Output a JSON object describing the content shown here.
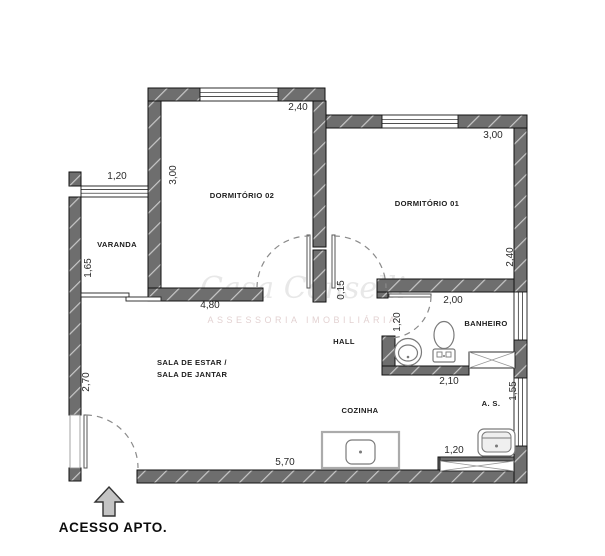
{
  "rooms": {
    "dorm02": "DORMITÓRIO 02",
    "dorm01": "DORMITÓRIO 01",
    "varanda": "VARANDA",
    "sala_line1": "SALA DE ESTAR /",
    "sala_line2": "SALA DE JANTAR",
    "hall": "HALL",
    "banheiro": "BANHEIRO",
    "cozinha": "COZINHA",
    "area_servico": "A. S."
  },
  "dimensions": {
    "dorm02_window": "2,40",
    "dorm02_depth": "3,00",
    "varanda_window": "1,20",
    "dorm01_window": "3,00",
    "dorm01_depth": "2,40",
    "varanda_depth": "1,65",
    "sala_width": "4,80",
    "wall_stub": "0,15",
    "banheiro_top": "2,00",
    "banheiro_door": "1,20",
    "banheiro_bottom": "2,10",
    "as_depth": "1,55",
    "as_window": "1,20",
    "bottom_width": "5,70",
    "left_wall": "2,70"
  },
  "entry": {
    "label": "ACESSO APTO."
  },
  "watermark": {
    "line1": "Casa Conselli",
    "line2": "ASSESSORIA IMOBILIÁRIA"
  },
  "colors": {
    "wall_fill": "#6e6e6e",
    "wall_hatch": "#c8c8c8",
    "outline": "#111111",
    "dim_text": "#2b2b2b",
    "room_text": "#1c1c1c",
    "watermark_gray": "#d9d9d9",
    "watermark_pink": "#dcc6c6"
  }
}
